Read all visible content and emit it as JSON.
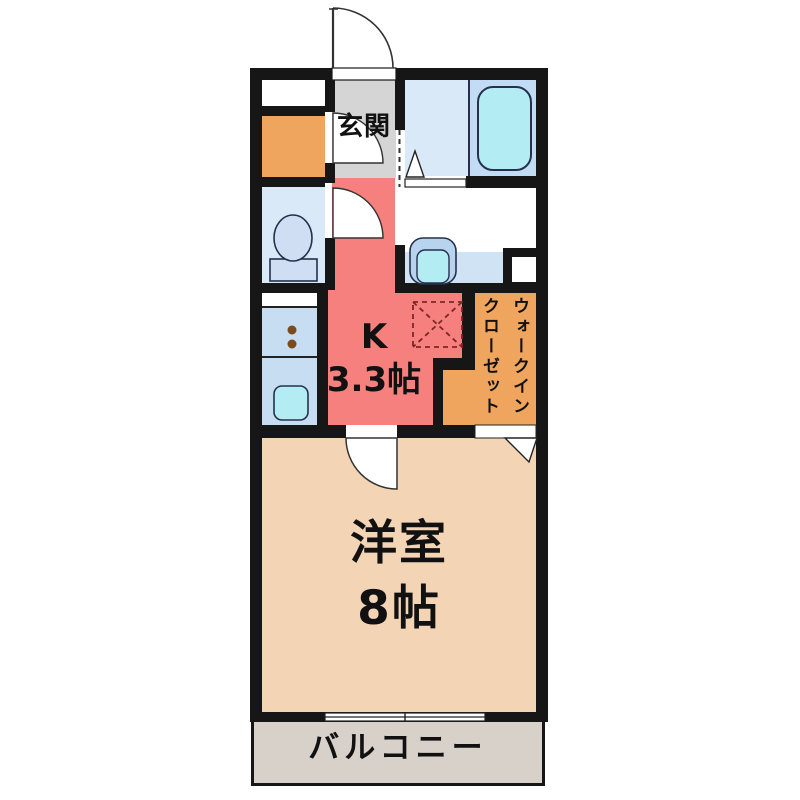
{
  "floorplan": {
    "type": "floor_plan",
    "rooms": {
      "entrance": {
        "label": "玄関"
      },
      "kitchen": {
        "label": "K",
        "size": "3.3帖"
      },
      "walk_in_closet": {
        "label_line1": "ウォークイン",
        "label_line2": "クローゼット"
      },
      "western_room": {
        "label": "洋室",
        "size": "8帖"
      },
      "balcony": {
        "label": "バルコニー"
      }
    },
    "icons": [
      "entrance-door-arc-icon",
      "interior-door-arc-icon",
      "toilet-icon",
      "washbasin-icon",
      "bathtub-icon",
      "kitchen-sink-icon",
      "stove-burners-icon",
      "refrigerator-space-icon",
      "door-triangle-icon",
      "sliding-window-icon"
    ],
    "colors": {
      "wall": "#161616",
      "entrance_floor": "#d5d5d5",
      "kitchen_floor": "#f5807e",
      "room_floor": "#f3d4b4",
      "closet_floor": "#efa55d",
      "wet_floor": "#d9e9f7",
      "counter": "#c7def2",
      "vanity_strip": "#cfe3f4",
      "tub_deck": "#c3dcf5",
      "fixture_fill": "#b4ecf4",
      "fixture_trim": "#b7d3ee",
      "toilet_fixture": "#cfdef2",
      "burner": "#7b4a1d",
      "fridge_dash": "#7d2727",
      "balcony_floor": "#d8d1ca"
    }
  }
}
